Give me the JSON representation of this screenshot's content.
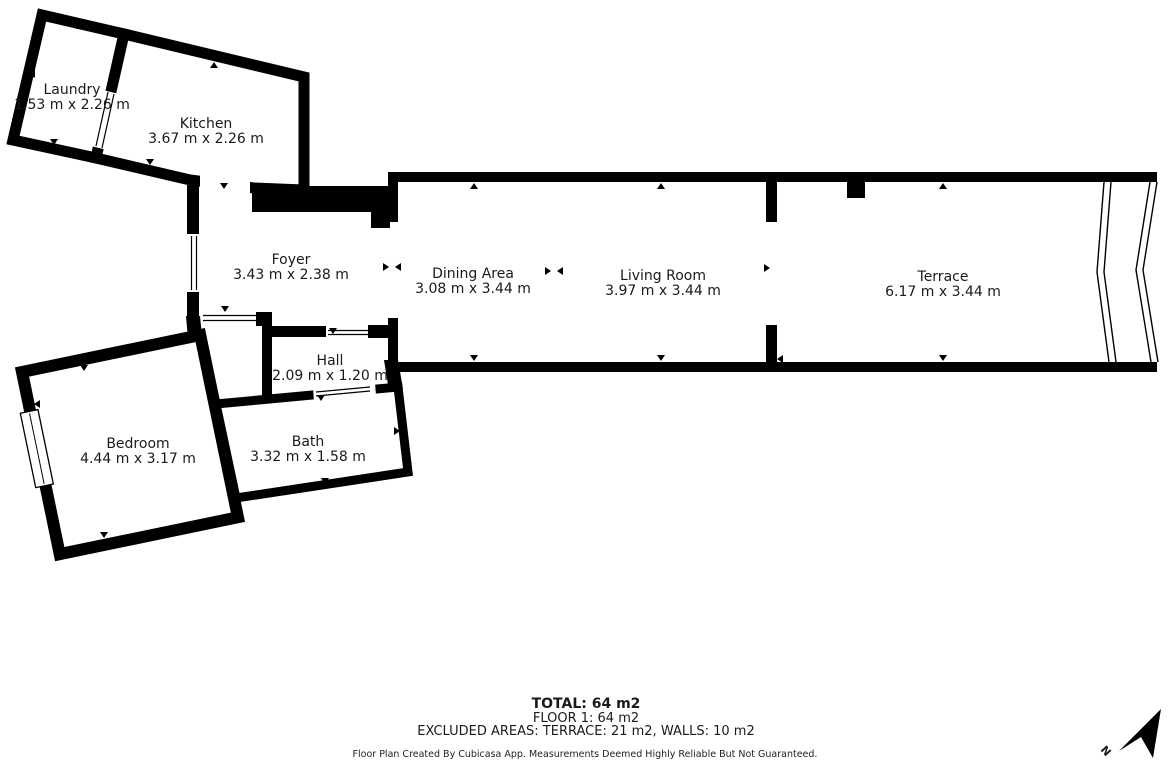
{
  "plan": {
    "rooms": [
      {
        "name": "Laundry",
        "dims": "1.53 m x 2.26 m"
      },
      {
        "name": "Kitchen",
        "dims": "3.67 m x 2.26 m"
      },
      {
        "name": "Foyer",
        "dims": "3.43 m x 2.38 m"
      },
      {
        "name": "Dining Area",
        "dims": "3.08 m x 3.44 m"
      },
      {
        "name": "Living Room",
        "dims": "3.97 m x 3.44 m"
      },
      {
        "name": "Terrace",
        "dims": "6.17 m x 3.44 m"
      },
      {
        "name": "Hall",
        "dims": "2.09 m x 1.20 m"
      },
      {
        "name": "Bedroom",
        "dims": "4.44 m x 3.17 m"
      },
      {
        "name": "Bath",
        "dims": "3.32 m x 1.58 m"
      }
    ],
    "summary": {
      "total": "TOTAL: 64 m2",
      "floor": "FLOOR 1: 64 m2",
      "excluded": "EXCLUDED AREAS: TERRACE: 21 m2, WALLS: 10 m2"
    },
    "disclaimer": "Floor Plan Created By Cubicasa App. Measurements Deemed Highly Reliable But Not Guaranteed.",
    "compass": {
      "north_label": "N"
    },
    "colors": {
      "wall": "#000000",
      "background": "#ffffff",
      "text": "#1a1a1a"
    }
  }
}
